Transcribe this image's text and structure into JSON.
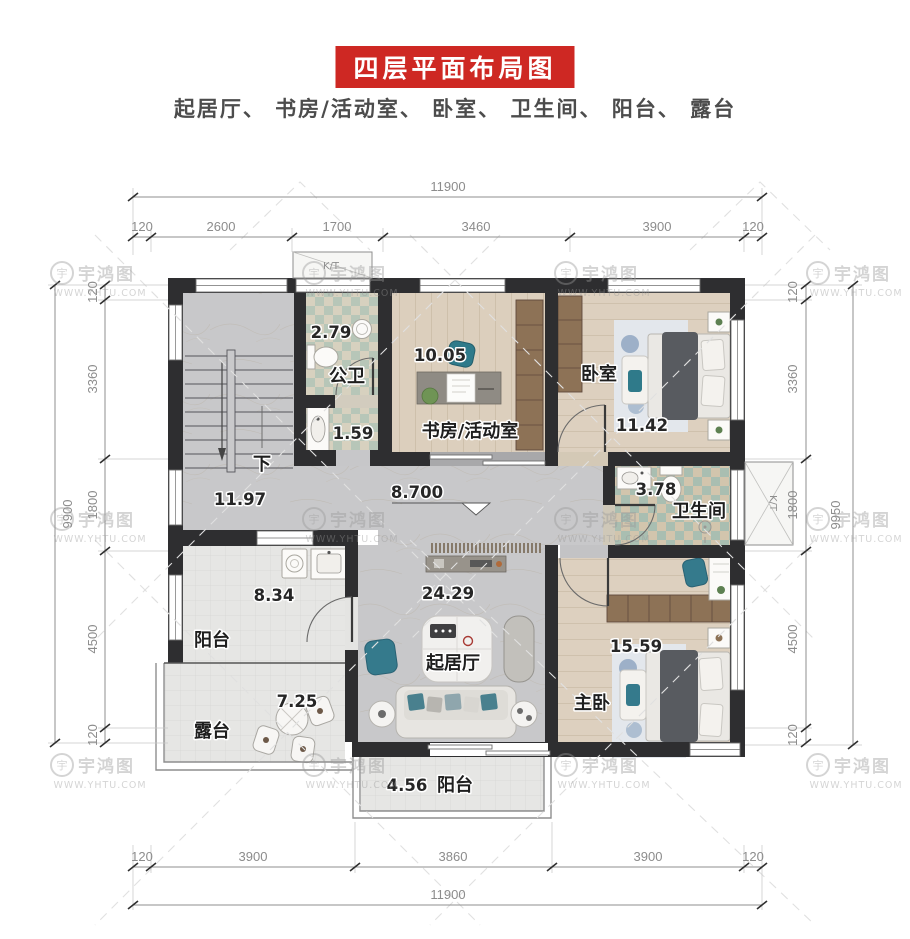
{
  "header": {
    "title": "四层平面布局图",
    "subtitle": "起居厅、 书房/活动室、 卧室、 卫生间、 阳台、 露台"
  },
  "colors": {
    "accent_red": "#ce2823"
  },
  "watermark": {
    "brand": "宇鸿图",
    "url": "WWW.YHTU.COM",
    "symbol": "宇"
  },
  "rooms": {
    "stair_hall": {
      "area": "11.97"
    },
    "public_bath": {
      "name": "公卫",
      "area": "2.79"
    },
    "wash": {
      "area": "1.59"
    },
    "study": {
      "name": "书房/活动室",
      "area": "10.05"
    },
    "bedroom": {
      "name": "卧室",
      "area": "11.42"
    },
    "bathroom": {
      "name": "卫生间",
      "area": "3.78"
    },
    "balcony_west": {
      "name": "阳台",
      "area": "8.34"
    },
    "terrace": {
      "name": "露台",
      "area": "7.25"
    },
    "living": {
      "name": "起居厅",
      "area": "24.29"
    },
    "master": {
      "name": "主卧",
      "area": "15.59"
    },
    "balcony_south": {
      "name": "阳台",
      "area": "4.56"
    }
  },
  "annotations": {
    "level": "8.700",
    "down": "下",
    "shaft": "K/T"
  },
  "dimensions": {
    "top": {
      "total": "11900",
      "segments": [
        "120",
        "2600",
        "1700",
        "3460",
        "3900",
        "120"
      ]
    },
    "bottom": {
      "total": "11900",
      "segments": [
        "120",
        "3900",
        "3860",
        "3900",
        "120"
      ]
    },
    "left": {
      "total": "9900",
      "segments": [
        "120",
        "3360",
        "1800",
        "4500",
        "120"
      ]
    },
    "right": {
      "total": "9950",
      "segments": [
        "120",
        "3360",
        "1800",
        "4500",
        "120"
      ]
    }
  }
}
